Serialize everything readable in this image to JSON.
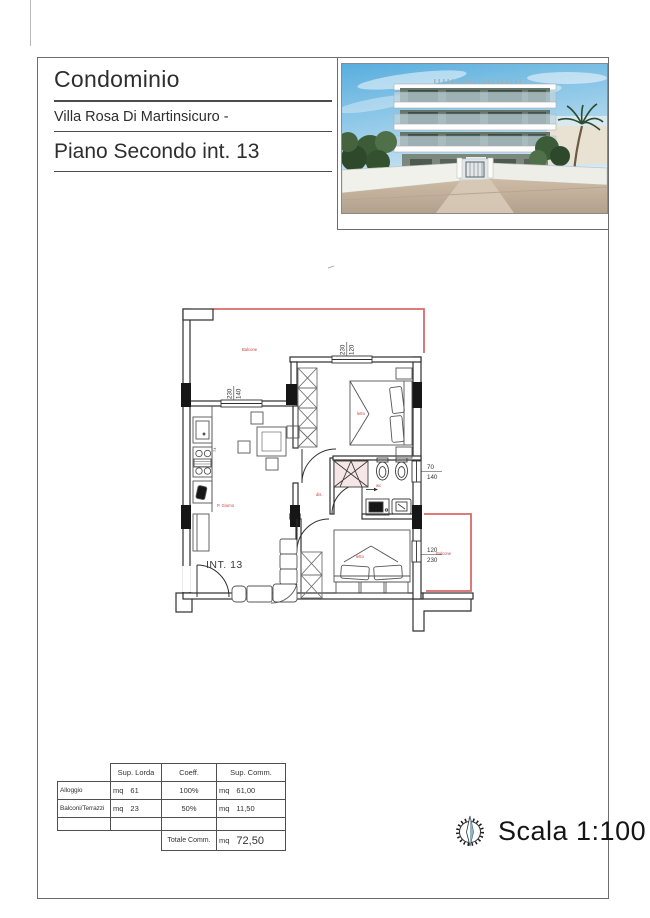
{
  "header": {
    "title": "Condominio",
    "subtitle": "Villa Rosa Di Martinsicuro -",
    "floor": "Piano Secondo int. 13"
  },
  "plan": {
    "unit": "INT. 13",
    "labels": {
      "balcony_top": "Balcone",
      "bedroom1": "letto",
      "bathroom": "wc",
      "hall": "dis.",
      "living": "P. Giorno",
      "bedroom2": "letto",
      "balcony_right": "Balcone",
      "kitchen_note": "74"
    },
    "dims": {
      "kitchen_window": {
        "w": "230",
        "h": "140"
      },
      "bed1_window": {
        "w": "230",
        "h": "120"
      },
      "bath_window": {
        "w": "70",
        "h": "140"
      },
      "bed2_window": {
        "w": "120",
        "h": "230"
      }
    }
  },
  "area_table": {
    "col_headers": [
      "Sup. Lorda",
      "Coeff.",
      "Sup. Comm."
    ],
    "unit": "mq",
    "rows": [
      {
        "label": "Alloggio",
        "lorda": "61",
        "coeff": "100%",
        "comm": "61,00"
      },
      {
        "label": "Balconi/Terrazzi",
        "lorda": "23",
        "coeff": "50%",
        "comm": "11,50"
      }
    ],
    "total_label": "Totale Comm.",
    "total": "72,50"
  },
  "footer": {
    "scale": "Scala 1:100"
  },
  "colors": {
    "plan_red": "#d96a6a",
    "label_red": "#c94444",
    "wall": "#303030",
    "sky": "#66b8e4"
  }
}
